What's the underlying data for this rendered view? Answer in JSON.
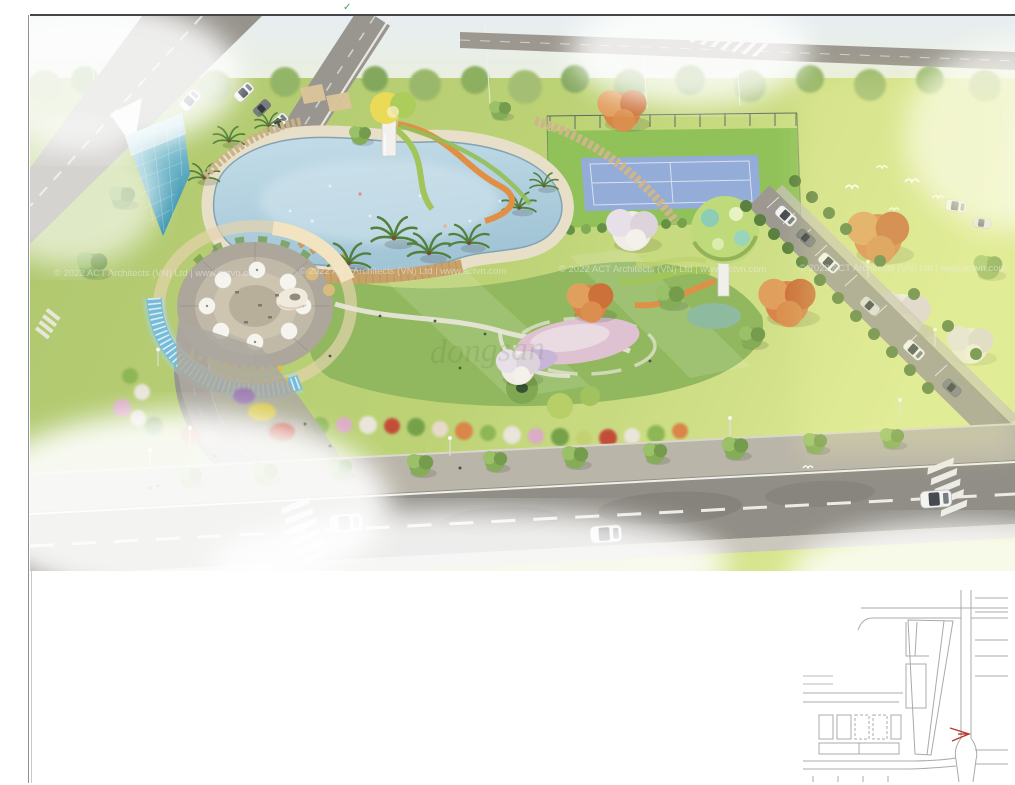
{
  "watermarks": {
    "copyright_line": "© 2022 ACT Architects (VN) Ltd | www.actvn.com",
    "center_mark": "dongsan"
  },
  "palette": {
    "pool_water": "#aecfdd",
    "park_lawn": "#8cb557",
    "field_green": "#b9d06e",
    "asphalt": "#8b8880",
    "deck_beige": "#e7dec6",
    "slide_orange": "#e08a3c",
    "slide_green": "#9cc253",
    "cascade_wall_blue": "#6fb9d6",
    "tennis_court_blue": "#8ea8d6",
    "flamboyant_orange": "#d97f3f",
    "monument_teal": "#49a8c0",
    "keymap_line_gray": "#a7abae",
    "keymap_marker_red": "#b63b2e"
  }
}
